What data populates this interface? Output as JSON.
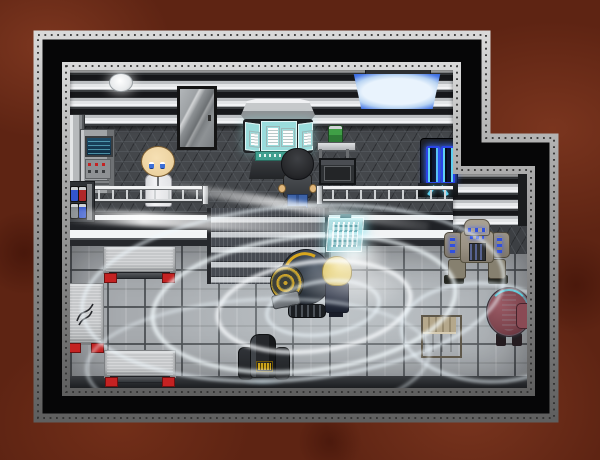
{
  "scene": {
    "genre": "top-down sci-fi RPG interior",
    "style": "RPG Maker style pixel art",
    "room": "laboratory with upper platform, staircase and lower machine bay",
    "exterior": "rust-red rocky ground",
    "lighting": "white spiral energy trails sweeping across the lower floor"
  },
  "entities": {
    "scientist": {
      "label": "Bald scientist in white lab coat standing behind the platform railing"
    },
    "operator": {
      "label": "Dark-haired man working at the curved control console"
    },
    "visitor": {
      "label": "Blond man in dark navy coat facing the drill robot"
    },
    "drill_mech": {
      "label": "Round dark drill robot with yellow ring accents"
    },
    "grey_mech": {
      "label": "Grey quad mech with glowing blue lights"
    },
    "red_mech": {
      "label": "Maroon rounded mech with cyan trim"
    },
    "service_droid": {
      "label": "Small black service droid with yellow label"
    }
  },
  "props": {
    "door": {
      "label": "Metal sliding door with glass panel"
    },
    "ceiling_light": {
      "label": "Round white ceiling light"
    },
    "blue_panel": {
      "label": "Blue glowing wall light panel"
    },
    "wall_console": {
      "label": "Wall instrument rack with blue screen and red buttons"
    },
    "can_rack": {
      "label": "Rack of supply canisters"
    },
    "control_console": {
      "label": "Curved command console with three cyan screens"
    },
    "shelf": {
      "label": "Metal shelf with green canister"
    },
    "chest": {
      "label": "Dark storage chest"
    },
    "teleporter": {
      "label": "Charging unit with twin blue coils"
    },
    "railing": {
      "label": "Platform safety railing"
    },
    "stairs": {
      "label": "Staircase to lower bay"
    },
    "holo_display": {
      "label": "Cyan holographic wall display"
    },
    "bench_top": {
      "label": "Brushed metal work table"
    },
    "bench_side": {
      "label": "Brushed metal side table with etched logo"
    },
    "bench_bottom": {
      "label": "Brushed metal work table"
    },
    "crate": {
      "label": "Slatted metal crate"
    }
  },
  "effects": {
    "energy_swirls": {
      "label": "White spiral energy trails"
    }
  },
  "palette": {
    "rust_base": "#5e2413",
    "rust_light": "#96462a",
    "rust_dark": "#3a0f06",
    "metal_light": "#d9d9d9",
    "metal_mid": "#a8a8a8",
    "metal_dark": "#5f5f5f",
    "rivet": "#2f2f2f",
    "void": "#060607",
    "stripe_dark": "#17181b",
    "stripe_light": "#e4e6e8",
    "hex_base": "#44474b",
    "hex_line": "#575b60",
    "midwall": "#24262a",
    "floor": "#a7abaf",
    "floor_grid": "#464a4e",
    "floor_strip": "#1c1e21",
    "stair_dark": "#474b52",
    "stair_light": "#c6cace",
    "panel_blue": "#2e5fd8",
    "panel_core": "#e9f3fd",
    "screen_cyan": "#9adcdc",
    "screen_teal": "#3f9f8f",
    "holo": "#a8e6ea",
    "tele_blue": "#2a44e8",
    "tele_cyan": "#5fd2f2",
    "table_metal": "#c6c8ca",
    "accent_red": "#c42222",
    "skin": "#ecd2a0",
    "coat_white": "#f2f2f4",
    "jeans": "#3c62a8",
    "hair_dark": "#27282b",
    "hair_blonde": "#e2cb6d",
    "coat_navy": "#272e40",
    "mech_dark": "#2c343e",
    "mech_yellow": "#d7a61e",
    "mech_grey": "#9a9284",
    "mech_blue": "#3050e0",
    "mech_maroon": "#7e454e",
    "crate": "#a99c84",
    "droid": "#26282c",
    "glow": "#eef7fb",
    "green_can": "#3f9f46"
  }
}
